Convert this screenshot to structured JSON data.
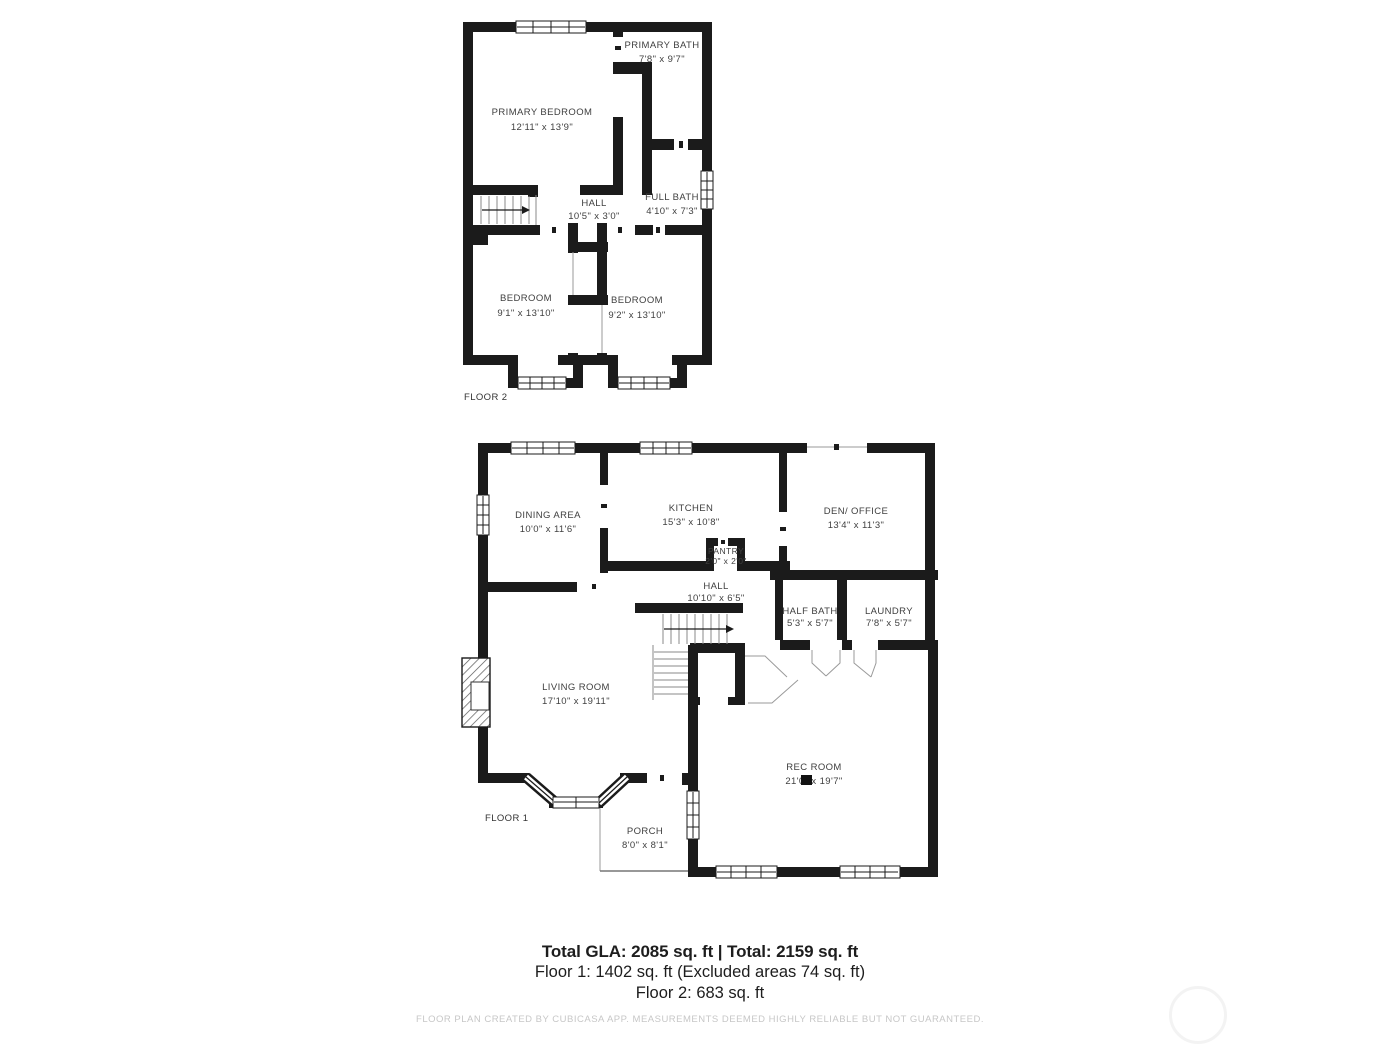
{
  "colors": {
    "wall": "#1b1b1b",
    "label_ink": "#3f3f3f",
    "thin_line": "#8a8a8a",
    "summary_ink": "#1d1d1d",
    "disclaimer_ink": "#c7c7c7",
    "watermark": "#f3f3f3"
  },
  "floor2": {
    "label": "FLOOR 2",
    "rooms": {
      "primary_bedroom": {
        "name": "PRIMARY BEDROOM",
        "dims": "12'11\" x 13'9\""
      },
      "primary_bath": {
        "name": "PRIMARY BATH",
        "dims": "7'8\" x 9'7\""
      },
      "hall": {
        "name": "HALL",
        "dims": "10'5\" x 3'0\""
      },
      "full_bath": {
        "name": "FULL BATH",
        "dims": "4'10\" x 7'3\""
      },
      "bedroom_left": {
        "name": "BEDROOM",
        "dims": "9'1\" x 13'10\""
      },
      "bedroom_right": {
        "name": "BEDROOM",
        "dims": "9'2\" x 13'10\""
      }
    }
  },
  "floor1": {
    "label": "FLOOR 1",
    "rooms": {
      "dining_area": {
        "name": "DINING AREA",
        "dims": "10'0\" x 11'6\""
      },
      "kitchen": {
        "name": "KITCHEN",
        "dims": "15'3\" x 10'8\""
      },
      "den_office": {
        "name": "DEN/ OFFICE",
        "dims": "13'4\" x 11'3\""
      },
      "pantry": {
        "name": "PANTRY",
        "dims": "2'0\" x 2'0\""
      },
      "hall": {
        "name": "HALL",
        "dims": "10'10\" x 6'5\""
      },
      "half_bath": {
        "name": "HALF BATH",
        "dims": "5'3\" x 5'7\""
      },
      "laundry": {
        "name": "LAUNDRY",
        "dims": "7'8\" x 5'7\""
      },
      "living_room": {
        "name": "LIVING ROOM",
        "dims": "17'10\" x 19'11\""
      },
      "rec_room": {
        "name": "REC ROOM",
        "dims": "21'0\" x 19'7\""
      },
      "porch": {
        "name": "PORCH",
        "dims": "8'0\" x 8'1\""
      }
    }
  },
  "summary": {
    "line1": "Total GLA: 2085 sq. ft | Total: 2159 sq. ft",
    "line2": "Floor 1: 1402 sq. ft (Excluded areas 74 sq. ft)",
    "line3": "Floor 2: 683 sq. ft"
  },
  "footer": {
    "disclaimer": "FLOOR PLAN CREATED BY CUBICASA APP. MEASUREMENTS DEEMED HIGHLY RELIABLE BUT NOT GUARANTEED."
  }
}
